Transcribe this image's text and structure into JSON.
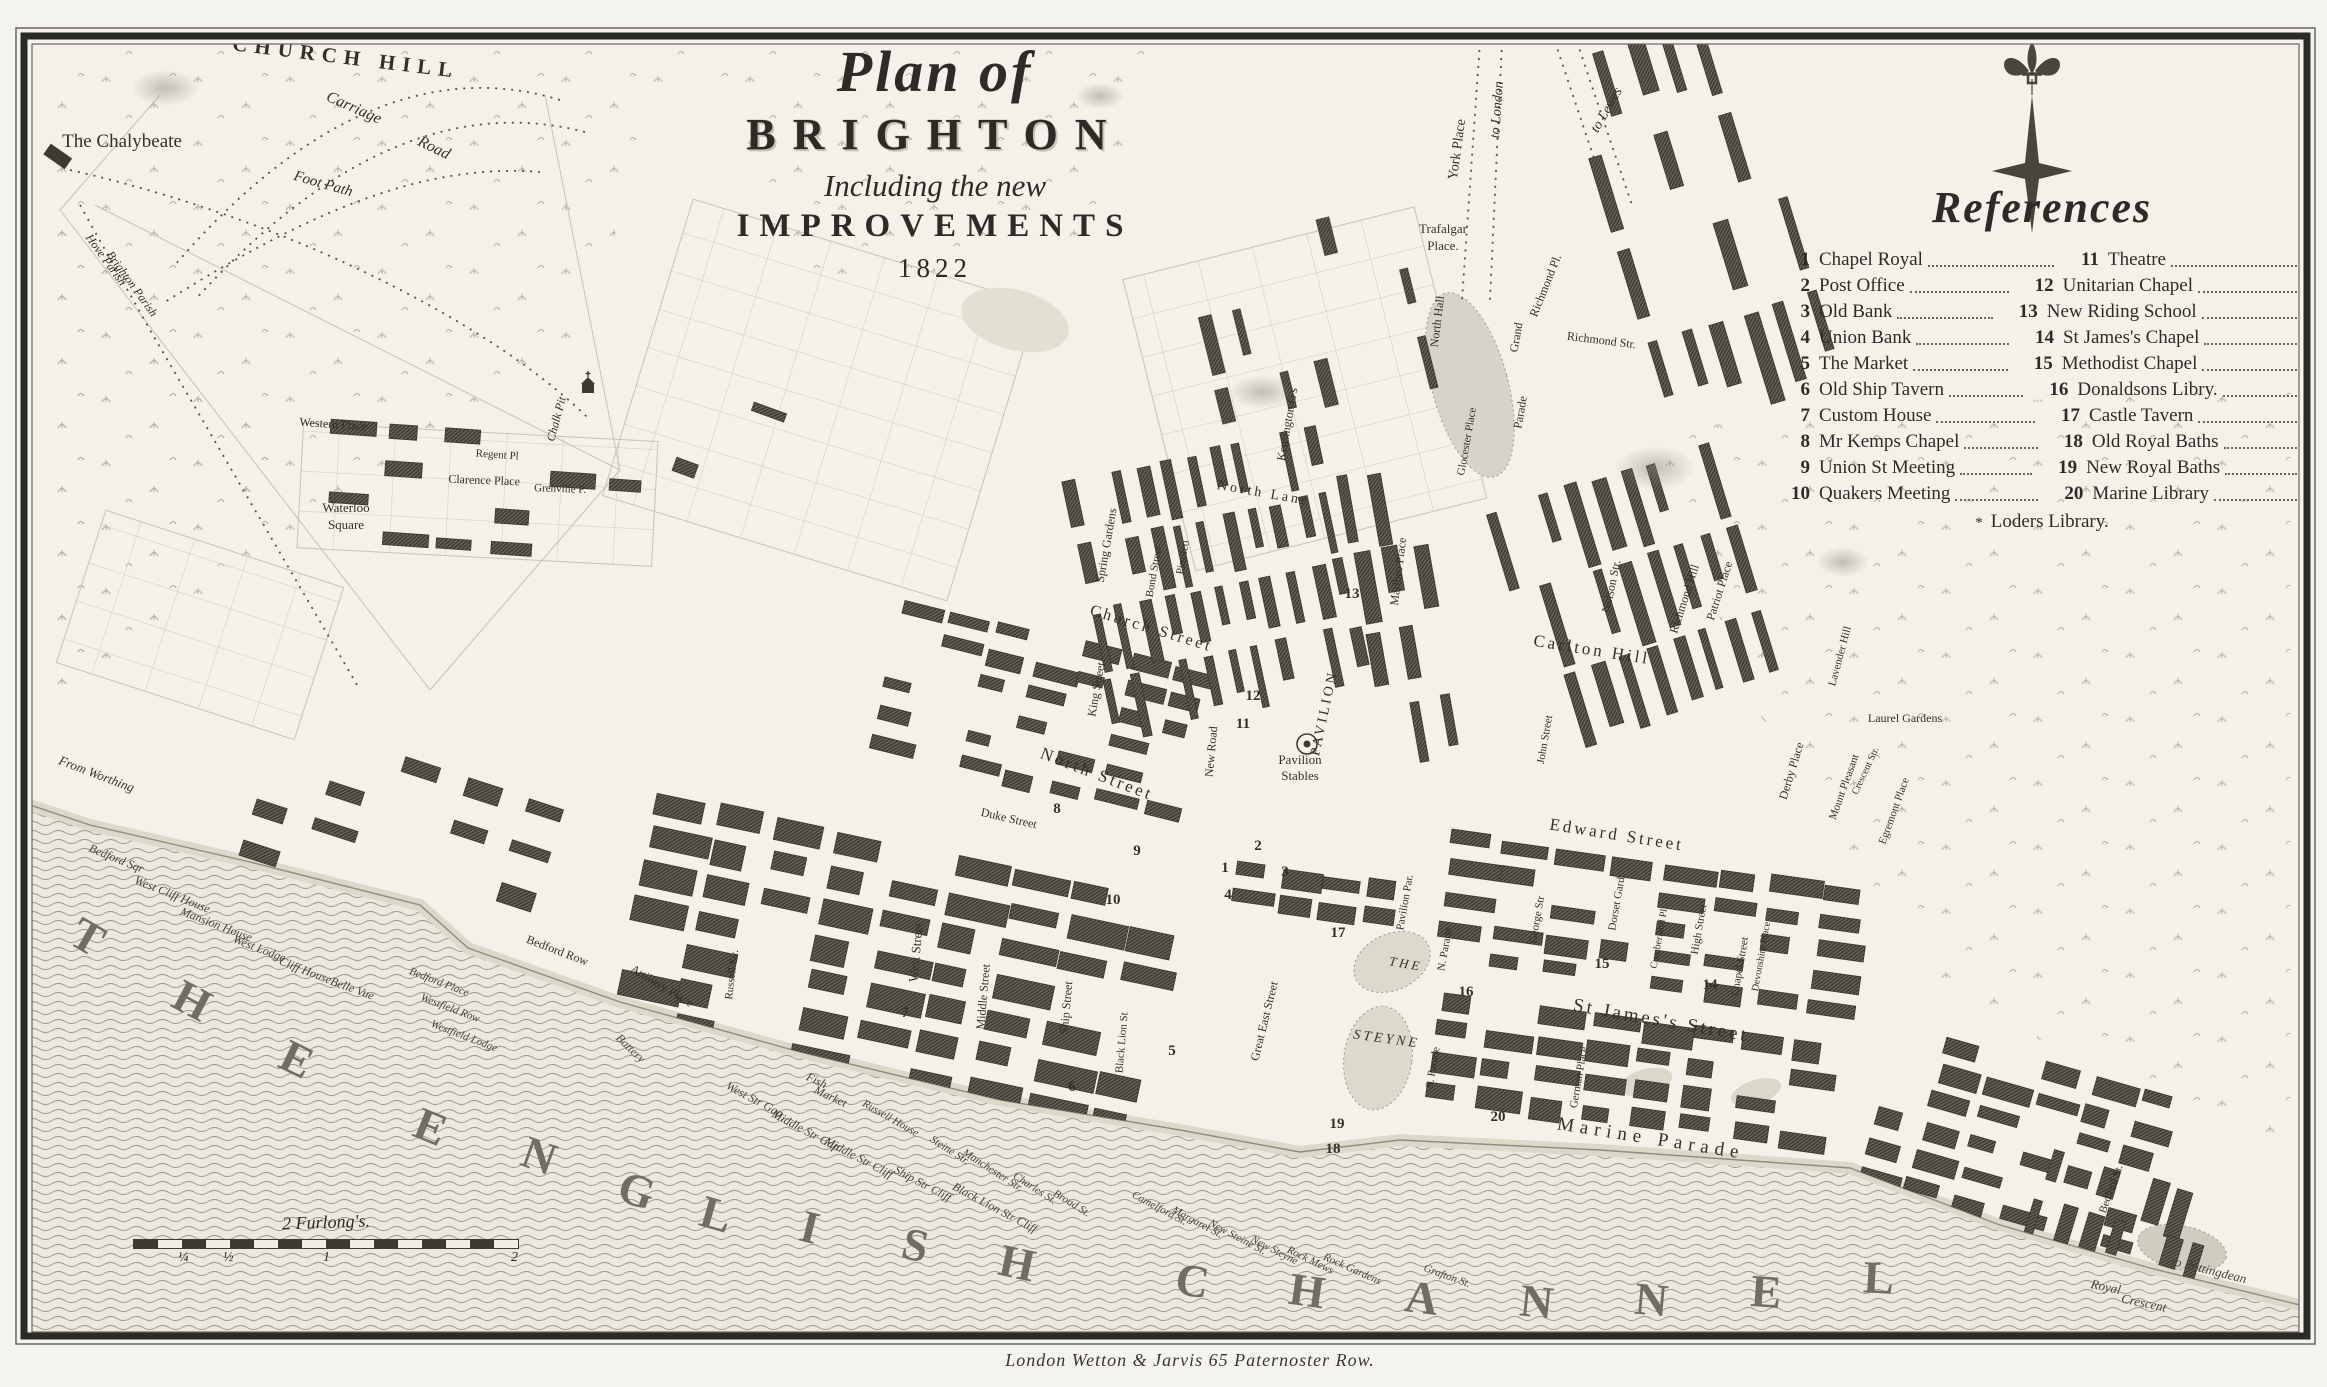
{
  "title": {
    "line1": "Plan of",
    "line2": "BRIGHTON",
    "line3": "Including the new",
    "line4": "IMPROVEMENTS",
    "year": "1822"
  },
  "references": {
    "heading": "References",
    "rows": [
      {
        "n1": "1",
        "l1": "Chapel Royal",
        "n2": "11",
        "l2": "Theatre"
      },
      {
        "n1": "2",
        "l1": "Post Office",
        "n2": "12",
        "l2": "Unitarian Chapel"
      },
      {
        "n1": "3",
        "l1": "Old Bank",
        "n2": "13",
        "l2": "New Riding School"
      },
      {
        "n1": "4",
        "l1": "Union Bank",
        "n2": "14",
        "l2": "St James's Chapel"
      },
      {
        "n1": "5",
        "l1": "The Market",
        "n2": "15",
        "l2": "Methodist Chapel"
      },
      {
        "n1": "6",
        "l1": "Old Ship Tavern",
        "n2": "16",
        "l2": "Donaldsons Libry."
      },
      {
        "n1": "7",
        "l1": "Custom House",
        "n2": "17",
        "l2": "Castle Tavern"
      },
      {
        "n1": "8",
        "l1": "Mr Kemps Chapel",
        "n2": "18",
        "l2": "Old Royal Baths"
      },
      {
        "n1": "9",
        "l1": "Union St Meeting",
        "n2": "19",
        "l2": "New Royal Baths"
      },
      {
        "n1": "10",
        "l1": "Quakers Meeting",
        "n2": "20",
        "l2": "Marine Library"
      }
    ],
    "footnote_marker": "*",
    "footnote": "Loders Library."
  },
  "scale_bar": {
    "label": "2 Furlong's.",
    "ticks": [
      "¼",
      "½",
      "1",
      "2"
    ]
  },
  "imprint": "London Wetton & Jarvis 65 Paternoster Row.",
  "compass": {
    "icon": "compass-fleur-de-lis"
  },
  "colors": {
    "ink": "#33302a",
    "paper": "#f3f1e9",
    "building": "#3e3a33",
    "water_line": "#9b968a"
  },
  "map_labels": [
    {
      "t": "CHURCH HILL",
      "x": 345,
      "y": 64,
      "r": 7,
      "s": 21,
      "c": "h"
    },
    {
      "t": "Carriage",
      "x": 352,
      "y": 112,
      "r": 24,
      "s": 16,
      "c": "i"
    },
    {
      "t": "Road",
      "x": 432,
      "y": 152,
      "r": 26,
      "s": 16,
      "c": "i"
    },
    {
      "t": "Foot Path",
      "x": 322,
      "y": 188,
      "r": 16,
      "s": 15,
      "c": "i"
    },
    {
      "t": "The Chalybeate",
      "x": 122,
      "y": 147,
      "r": 0,
      "s": 19,
      "c": ""
    },
    {
      "t": "Hove Parish",
      "x": 103,
      "y": 262,
      "r": 54,
      "s": 12,
      "c": "i"
    },
    {
      "t": "Brighton Parish",
      "x": 129,
      "y": 286,
      "r": 54,
      "s": 12,
      "c": "i"
    },
    {
      "t": "Chalk Pit",
      "x": 560,
      "y": 420,
      "r": -75,
      "s": 12,
      "c": "i"
    },
    {
      "t": "York Place",
      "x": 1461,
      "y": 150,
      "r": -82,
      "s": 14,
      "c": ""
    },
    {
      "t": "to London",
      "x": 1501,
      "y": 110,
      "r": -86,
      "s": 14,
      "c": "i"
    },
    {
      "t": "to Lewes",
      "x": 1610,
      "y": 112,
      "r": -60,
      "s": 14,
      "c": "i"
    },
    {
      "t": "Trafalgar",
      "x": 1443,
      "y": 233,
      "r": 0,
      "s": 13,
      "c": ""
    },
    {
      "t": "Place.",
      "x": 1443,
      "y": 250,
      "r": 0,
      "s": 13,
      "c": ""
    },
    {
      "t": "North Hall",
      "x": 1441,
      "y": 322,
      "r": -83,
      "s": 12,
      "c": ""
    },
    {
      "t": "Richmond Pl.",
      "x": 1549,
      "y": 287,
      "r": -68,
      "s": 12,
      "c": ""
    },
    {
      "t": "Richmond Str.",
      "x": 1601,
      "y": 344,
      "r": 7,
      "s": 12,
      "c": ""
    },
    {
      "t": "Grand",
      "x": 1520,
      "y": 338,
      "r": -80,
      "s": 12,
      "c": ""
    },
    {
      "t": "Parade",
      "x": 1524,
      "y": 413,
      "r": -80,
      "s": 12,
      "c": ""
    },
    {
      "t": "Kensington G's",
      "x": 1291,
      "y": 425,
      "r": -80,
      "s": 12,
      "c": ""
    },
    {
      "t": "Glocester Place",
      "x": 1470,
      "y": 442,
      "r": -80,
      "s": 11,
      "c": ""
    },
    {
      "t": "Richmond Hill",
      "x": 1688,
      "y": 600,
      "r": -72,
      "s": 12,
      "c": ""
    },
    {
      "t": "Patriot Place",
      "x": 1723,
      "y": 592,
      "r": -72,
      "s": 12,
      "c": ""
    },
    {
      "t": "Nelson Str.",
      "x": 1615,
      "y": 587,
      "r": -78,
      "s": 12,
      "c": ""
    },
    {
      "t": "Carlton Hill",
      "x": 1591,
      "y": 655,
      "r": 9,
      "s": 17,
      "c": "cap"
    },
    {
      "t": "John Street",
      "x": 1548,
      "y": 740,
      "r": -80,
      "s": 11,
      "c": ""
    },
    {
      "t": "Edward Street",
      "x": 1616,
      "y": 840,
      "r": 9,
      "s": 17,
      "c": "cap"
    },
    {
      "t": "Derby Place",
      "x": 1795,
      "y": 772,
      "r": -73,
      "s": 12,
      "c": ""
    },
    {
      "t": "Mount Pleasant",
      "x": 1847,
      "y": 788,
      "r": -70,
      "s": 11,
      "c": ""
    },
    {
      "t": "Egremont Place",
      "x": 1897,
      "y": 812,
      "r": -70,
      "s": 11,
      "c": ""
    },
    {
      "t": "Marlbro Place",
      "x": 1402,
      "y": 572,
      "r": -83,
      "s": 12,
      "c": ""
    },
    {
      "t": "North Lane",
      "x": 1263,
      "y": 497,
      "r": 10,
      "s": 14,
      "c": "cap"
    },
    {
      "t": "Spring Gardens",
      "x": 1110,
      "y": 546,
      "r": -80,
      "s": 12,
      "c": ""
    },
    {
      "t": "Bond Street",
      "x": 1157,
      "y": 572,
      "r": -80,
      "s": 11,
      "c": ""
    },
    {
      "t": "Pimlico",
      "x": 1186,
      "y": 558,
      "r": -80,
      "s": 11,
      "c": ""
    },
    {
      "t": "King Street",
      "x": 1100,
      "y": 690,
      "r": -80,
      "s": 12,
      "c": ""
    },
    {
      "t": "Church Street",
      "x": 1150,
      "y": 633,
      "r": 17,
      "s": 16,
      "c": "cap"
    },
    {
      "t": "New Road",
      "x": 1215,
      "y": 752,
      "r": -85,
      "s": 12,
      "c": ""
    },
    {
      "t": "Pavilion",
      "x": 1300,
      "y": 764,
      "r": 0,
      "s": 13,
      "c": ""
    },
    {
      "t": "Stables",
      "x": 1300,
      "y": 780,
      "r": 0,
      "s": 13,
      "c": ""
    },
    {
      "t": "North Street",
      "x": 1095,
      "y": 779,
      "r": 21,
      "s": 17,
      "c": "cap"
    },
    {
      "t": "Great East Street",
      "x": 1268,
      "y": 1022,
      "r": -76,
      "s": 12,
      "c": ""
    },
    {
      "t": "Duke Street",
      "x": 1008,
      "y": 822,
      "r": 13,
      "s": 12,
      "c": ""
    },
    {
      "t": "West Street",
      "x": 920,
      "y": 953,
      "r": -85,
      "s": 13,
      "c": ""
    },
    {
      "t": "Middle Street",
      "x": 987,
      "y": 997,
      "r": -85,
      "s": 12,
      "c": ""
    },
    {
      "t": "Ship Street",
      "x": 1070,
      "y": 1008,
      "r": -85,
      "s": 12,
      "c": ""
    },
    {
      "t": "Black Lion St",
      "x": 1125,
      "y": 1043,
      "r": -85,
      "s": 11,
      "c": ""
    },
    {
      "t": "Russell Str.",
      "x": 735,
      "y": 975,
      "r": -83,
      "s": 11,
      "c": ""
    },
    {
      "t": "Bedford Row",
      "x": 556,
      "y": 954,
      "r": 21,
      "s": 12,
      "c": ""
    },
    {
      "t": "Artillery Place",
      "x": 660,
      "y": 989,
      "r": 31,
      "s": 12,
      "c": ""
    },
    {
      "t": "Western Place",
      "x": 333,
      "y": 428,
      "r": 4,
      "s": 12,
      "c": ""
    },
    {
      "t": "Regent Pl",
      "x": 497,
      "y": 458,
      "r": 4,
      "s": 11,
      "c": ""
    },
    {
      "t": "Clarence Place",
      "x": 484,
      "y": 484,
      "r": 2,
      "s": 12,
      "c": ""
    },
    {
      "t": "Waterloo",
      "x": 346,
      "y": 512,
      "r": 0,
      "s": 13,
      "c": ""
    },
    {
      "t": "Square",
      "x": 346,
      "y": 529,
      "r": 0,
      "s": 13,
      "c": ""
    },
    {
      "t": "Grenville P.",
      "x": 560,
      "y": 492,
      "r": 2,
      "s": 11,
      "c": ""
    },
    {
      "t": "From Worthing",
      "x": 95,
      "y": 778,
      "r": 21,
      "s": 13,
      "c": "i"
    },
    {
      "t": "PAVILION",
      "x": 1328,
      "y": 714,
      "r": -78,
      "s": 14,
      "c": "cap"
    },
    {
      "t": "THE",
      "x": 1405,
      "y": 968,
      "r": 10,
      "s": 13,
      "c": "i cap"
    },
    {
      "t": "STEYNE",
      "x": 1386,
      "y": 1043,
      "r": 8,
      "s": 14,
      "c": "i cap"
    },
    {
      "t": "Pavilion Par.",
      "x": 1408,
      "y": 903,
      "r": -80,
      "s": 11,
      "c": ""
    },
    {
      "t": "N. Parade",
      "x": 1448,
      "y": 950,
      "r": -80,
      "s": 11,
      "c": ""
    },
    {
      "t": "S. Parade",
      "x": 1436,
      "y": 1068,
      "r": -80,
      "s": 11,
      "c": ""
    },
    {
      "t": "St James's Street",
      "x": 1660,
      "y": 1026,
      "r": 10,
      "s": 19,
      "c": "cap"
    },
    {
      "t": "Marine Parade",
      "x": 1650,
      "y": 1144,
      "r": 9,
      "s": 19,
      "c": "wide"
    },
    {
      "t": "George Str",
      "x": 1540,
      "y": 920,
      "r": -80,
      "s": 11,
      "c": ""
    },
    {
      "t": "Dorset Gard.",
      "x": 1620,
      "y": 903,
      "r": -80,
      "s": 11,
      "c": ""
    },
    {
      "t": "Cumberland Pl.",
      "x": 1662,
      "y": 938,
      "r": -80,
      "s": 10,
      "c": ""
    },
    {
      "t": "High Street",
      "x": 1702,
      "y": 930,
      "r": -80,
      "s": 11,
      "c": ""
    },
    {
      "t": "Chapel Street",
      "x": 1743,
      "y": 967,
      "r": -80,
      "s": 11,
      "c": ""
    },
    {
      "t": "Devonshire Place",
      "x": 1764,
      "y": 957,
      "r": -80,
      "s": 10,
      "c": ""
    },
    {
      "t": "German Place",
      "x": 1582,
      "y": 1078,
      "r": -80,
      "s": 11,
      "c": ""
    },
    {
      "t": "Laurel Gardens",
      "x": 1905,
      "y": 722,
      "r": 0,
      "s": 12,
      "c": ""
    },
    {
      "t": "Lavender Hill",
      "x": 1843,
      "y": 657,
      "r": -75,
      "s": 11,
      "c": ""
    },
    {
      "t": "Crescent Str.",
      "x": 1868,
      "y": 772,
      "r": -65,
      "s": 10,
      "c": ""
    },
    {
      "t": "Bedford St.",
      "x": 2114,
      "y": 1190,
      "r": -70,
      "s": 11,
      "c": ""
    },
    {
      "t": "to Rottingdean",
      "x": 2208,
      "y": 1274,
      "r": 14,
      "s": 13,
      "c": "i seal"
    },
    {
      "t": "Royal",
      "x": 2105,
      "y": 1291,
      "r": 12,
      "s": 13,
      "c": "i seal"
    },
    {
      "t": "Crescent",
      "x": 2143,
      "y": 1307,
      "r": 12,
      "s": 13,
      "c": "i seal"
    },
    {
      "t": "Fish",
      "x": 815,
      "y": 1084,
      "r": 25,
      "s": 12,
      "c": "i seal"
    },
    {
      "t": "Market",
      "x": 829,
      "y": 1100,
      "r": 25,
      "s": 12,
      "c": "i seal"
    },
    {
      "t": "Russell House",
      "x": 889,
      "y": 1121,
      "r": 30,
      "s": 11,
      "c": "i seal"
    },
    {
      "t": "Steine Str.",
      "x": 948,
      "y": 1153,
      "r": 33,
      "s": 11,
      "c": "i seal"
    },
    {
      "t": "Manchester Str.",
      "x": 991,
      "y": 1173,
      "r": 33,
      "s": 11,
      "c": "i seal"
    },
    {
      "t": "Charles St.",
      "x": 1033,
      "y": 1191,
      "r": 33,
      "s": 11,
      "c": "i seal"
    },
    {
      "t": "Broad St.",
      "x": 1070,
      "y": 1206,
      "r": 32,
      "s": 11,
      "c": "i seal"
    },
    {
      "t": "Camelford St.",
      "x": 1158,
      "y": 1211,
      "r": 28,
      "s": 11,
      "c": "i seal"
    },
    {
      "t": "Margaret St.",
      "x": 1196,
      "y": 1225,
      "r": 28,
      "s": 11,
      "c": "i seal"
    },
    {
      "t": "New Steine St.",
      "x": 1236,
      "y": 1240,
      "r": 28,
      "s": 11,
      "c": "i seal"
    },
    {
      "t": "New Steyne",
      "x": 1273,
      "y": 1253,
      "r": 27,
      "s": 11,
      "c": "i seal"
    },
    {
      "t": "Rock Mews",
      "x": 1309,
      "y": 1263,
      "r": 26,
      "s": 11,
      "c": "i seal"
    },
    {
      "t": "Rock Gardens",
      "x": 1351,
      "y": 1272,
      "r": 24,
      "s": 11,
      "c": "i seal"
    },
    {
      "t": "Grafton St.",
      "x": 1446,
      "y": 1279,
      "r": 20,
      "s": 11,
      "c": "i seal"
    },
    {
      "t": "Bedford Sqr",
      "x": 115,
      "y": 862,
      "r": 22,
      "s": 12,
      "c": "i seal"
    },
    {
      "t": "West Cliff House",
      "x": 171,
      "y": 898,
      "r": 22,
      "s": 12,
      "c": "i seal"
    },
    {
      "t": "Mansion House",
      "x": 215,
      "y": 928,
      "r": 21,
      "s": 12,
      "c": "i seal"
    },
    {
      "t": "West Lodge",
      "x": 258,
      "y": 952,
      "r": 21,
      "s": 12,
      "c": "i seal"
    },
    {
      "t": "Cliff House",
      "x": 304,
      "y": 974,
      "r": 21,
      "s": 12,
      "c": "i seal"
    },
    {
      "t": "Belle Vue",
      "x": 351,
      "y": 992,
      "r": 20,
      "s": 12,
      "c": "i seal"
    },
    {
      "t": "Bedford Place",
      "x": 438,
      "y": 985,
      "r": 21,
      "s": 11,
      "c": "i seal"
    },
    {
      "t": "Westfield Row",
      "x": 449,
      "y": 1011,
      "r": 21,
      "s": 11,
      "c": "i seal"
    },
    {
      "t": "Westfield Lodge",
      "x": 463,
      "y": 1039,
      "r": 21,
      "s": 11,
      "c": "i seal"
    },
    {
      "t": "Battery",
      "x": 628,
      "y": 1051,
      "r": 44,
      "s": 12,
      "c": "i seal"
    },
    {
      "t": "West Str Gap",
      "x": 753,
      "y": 1103,
      "r": 28,
      "s": 12,
      "c": "i seal"
    },
    {
      "t": "Middle Str Gap",
      "x": 804,
      "y": 1134,
      "r": 28,
      "s": 12,
      "c": "i seal"
    },
    {
      "t": "Middle Str Cliff",
      "x": 857,
      "y": 1161,
      "r": 28,
      "s": 12,
      "c": "i seal"
    },
    {
      "t": "Ship Str Cliff",
      "x": 921,
      "y": 1187,
      "r": 28,
      "s": 12,
      "c": "i seal"
    },
    {
      "t": "Black Lion Str Cliff",
      "x": 993,
      "y": 1211,
      "r": 28,
      "s": 12,
      "c": "i seal"
    },
    {
      "t": "T",
      "x": 80,
      "y": 950,
      "r": 30,
      "s": 46,
      "c": "sea"
    },
    {
      "t": "H",
      "x": 185,
      "y": 1014,
      "r": 28,
      "s": 46,
      "c": "sea"
    },
    {
      "t": "E",
      "x": 290,
      "y": 1073,
      "r": 26,
      "s": 46,
      "c": "sea"
    },
    {
      "t": "E",
      "x": 425,
      "y": 1141,
      "r": 22,
      "s": 46,
      "c": "sea"
    },
    {
      "t": "N",
      "x": 534,
      "y": 1170,
      "r": 20,
      "s": 46,
      "c": "sea"
    },
    {
      "t": "G",
      "x": 632,
      "y": 1205,
      "r": 18,
      "s": 46,
      "c": "sea"
    },
    {
      "t": "L",
      "x": 712,
      "y": 1229,
      "r": 16,
      "s": 46,
      "c": "sea"
    },
    {
      "t": "I",
      "x": 806,
      "y": 1242,
      "r": 14,
      "s": 46,
      "c": "sea"
    },
    {
      "t": "S",
      "x": 912,
      "y": 1260,
      "r": 13,
      "s": 46,
      "c": "sea"
    },
    {
      "t": "H",
      "x": 1014,
      "y": 1278,
      "r": 12,
      "s": 46,
      "c": "sea"
    },
    {
      "t": "C",
      "x": 1190,
      "y": 1296,
      "r": 9,
      "s": 46,
      "c": "sea"
    },
    {
      "t": "H",
      "x": 1305,
      "y": 1306,
      "r": 8,
      "s": 46,
      "c": "sea"
    },
    {
      "t": "A",
      "x": 1420,
      "y": 1313,
      "r": 7,
      "s": 46,
      "c": "sea"
    },
    {
      "t": "N",
      "x": 1535,
      "y": 1317,
      "r": 6,
      "s": 46,
      "c": "sea"
    },
    {
      "t": "N",
      "x": 1650,
      "y": 1315,
      "r": 5,
      "s": 46,
      "c": "sea"
    },
    {
      "t": "E",
      "x": 1765,
      "y": 1307,
      "r": 4,
      "s": 46,
      "c": "sea"
    },
    {
      "t": "L",
      "x": 1878,
      "y": 1293,
      "r": 3,
      "s": 46,
      "c": "sea"
    }
  ],
  "ref_numbers": [
    {
      "n": "1",
      "x": 1225,
      "y": 872
    },
    {
      "n": "2",
      "x": 1258,
      "y": 850
    },
    {
      "n": "3",
      "x": 1285,
      "y": 876
    },
    {
      "n": "4",
      "x": 1228,
      "y": 899
    },
    {
      "n": "5",
      "x": 1172,
      "y": 1055
    },
    {
      "n": "6",
      "x": 1072,
      "y": 1091
    },
    {
      "n": "7",
      "x": 905,
      "y": 1017
    },
    {
      "n": "8",
      "x": 1057,
      "y": 813
    },
    {
      "n": "9",
      "x": 1137,
      "y": 855
    },
    {
      "n": "10",
      "x": 1113,
      "y": 904
    },
    {
      "n": "11",
      "x": 1243,
      "y": 728
    },
    {
      "n": "12",
      "x": 1253,
      "y": 700
    },
    {
      "n": "13",
      "x": 1352,
      "y": 598
    },
    {
      "n": "14",
      "x": 1710,
      "y": 989
    },
    {
      "n": "15",
      "x": 1602,
      "y": 968
    },
    {
      "n": "16",
      "x": 1466,
      "y": 996
    },
    {
      "n": "17",
      "x": 1338,
      "y": 937
    },
    {
      "n": "18",
      "x": 1333,
      "y": 1153
    },
    {
      "n": "19",
      "x": 1337,
      "y": 1128
    },
    {
      "n": "20",
      "x": 1498,
      "y": 1121
    }
  ]
}
